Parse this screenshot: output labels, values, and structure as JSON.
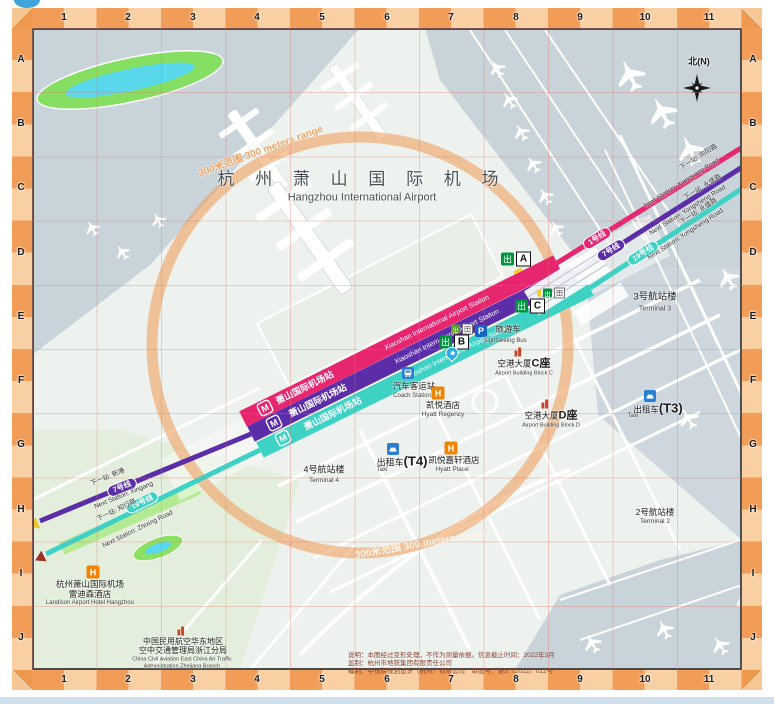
{
  "border": {
    "columns": [
      "1",
      "2",
      "3",
      "4",
      "5",
      "6",
      "7",
      "8",
      "9",
      "10",
      "11"
    ],
    "rows": [
      "A",
      "B",
      "C",
      "D",
      "E",
      "F",
      "G",
      "H",
      "I",
      "J"
    ]
  },
  "title": {
    "zh": "杭 州 萧 山 国 际 机 场",
    "en": "Hangzhou International Airport"
  },
  "compass": {
    "label": "北(N)"
  },
  "range_circle": {
    "zh": "300米范围",
    "en": "300 meters range"
  },
  "station": {
    "zh": "萧山国际机场站",
    "en": "Xiaoshan International Airport Station"
  },
  "lines": {
    "line1": {
      "name": "1号线",
      "color": "#e8256f",
      "next_ne_zh": "下一站: 向阳路",
      "next_ne_en": "Next Station: Xiangyang Road"
    },
    "line7": {
      "name": "7号线",
      "color": "#5b2da8",
      "next_ne_zh": "下一站: 永盛路",
      "next_ne_en": "Next Station: Yongsheng Road",
      "next_sw_zh": "下一站: 新港",
      "next_sw_en": "Next Station: Xingang"
    },
    "line19": {
      "name": "19号线",
      "color": "#3ed2c5",
      "next_ne_zh": "下一站: 永盛路",
      "next_ne_en": "Next Station: Yongsheng Road",
      "next_sw_zh": "下一站: 知行路",
      "next_sw_en": "Next Station: Zhixing Road"
    }
  },
  "exits": {
    "glyph": "出",
    "a": "A",
    "b": "B",
    "c": "C",
    "elevator": "田"
  },
  "icons": {
    "hotel": "H",
    "parking": "P",
    "metro": "M"
  },
  "pois": {
    "terminal3": {
      "zh": "3号航站楼",
      "en": "Terminal 3"
    },
    "terminal4": {
      "zh": "4号航站楼",
      "en": "Terminal 4"
    },
    "terminal2": {
      "zh": "2号航站楼",
      "en": "Terminal 2"
    },
    "taxi_t3": {
      "zh": "出租车",
      "suffix": "(T3)",
      "en": "Taxi"
    },
    "taxi_t4": {
      "zh": "出租车",
      "suffix": "(T4)",
      "en": "Taxi"
    },
    "coach": {
      "zh": "汽车客运站",
      "en": "Coach Station"
    },
    "hyatt_regency": {
      "zh": "凯悦酒店",
      "en": "Hyatt Regency"
    },
    "hyatt_place": {
      "zh": "凯悦嘉轩酒店",
      "en": "Hyatt Place"
    },
    "building_c": {
      "zh": "空港大厦",
      "suffix": "C座",
      "en": "Airport Building Block C"
    },
    "building_d": {
      "zh": "空港大厦",
      "suffix": "D座",
      "en": "Airport Building Block D"
    },
    "sightseeing": {
      "zh": "旅游车",
      "en": "Sightseeing Bus"
    },
    "landison": {
      "zh1": "杭州萧山国际机场",
      "zh2": "雷迪森酒店",
      "en": "Landison Airport Hotel Hangzhou"
    },
    "atc": {
      "zh1": "中国民用航空华东地区",
      "zh2": "空中交通管理局浙江分局",
      "en1": "China Civil Aviation East China Air Traffic",
      "en2": "Administration Zhejiang Branch"
    }
  },
  "notes": {
    "line1": "说明：本图经过变形处理，不作为测量依据。信息截止时间：2022年3月",
    "line2": "监制：杭州市地铁集团有限责任公司",
    "line3": "编制：中规院规划设计（杭州）有限公司　审图号：浙S（2022）012号"
  }
}
